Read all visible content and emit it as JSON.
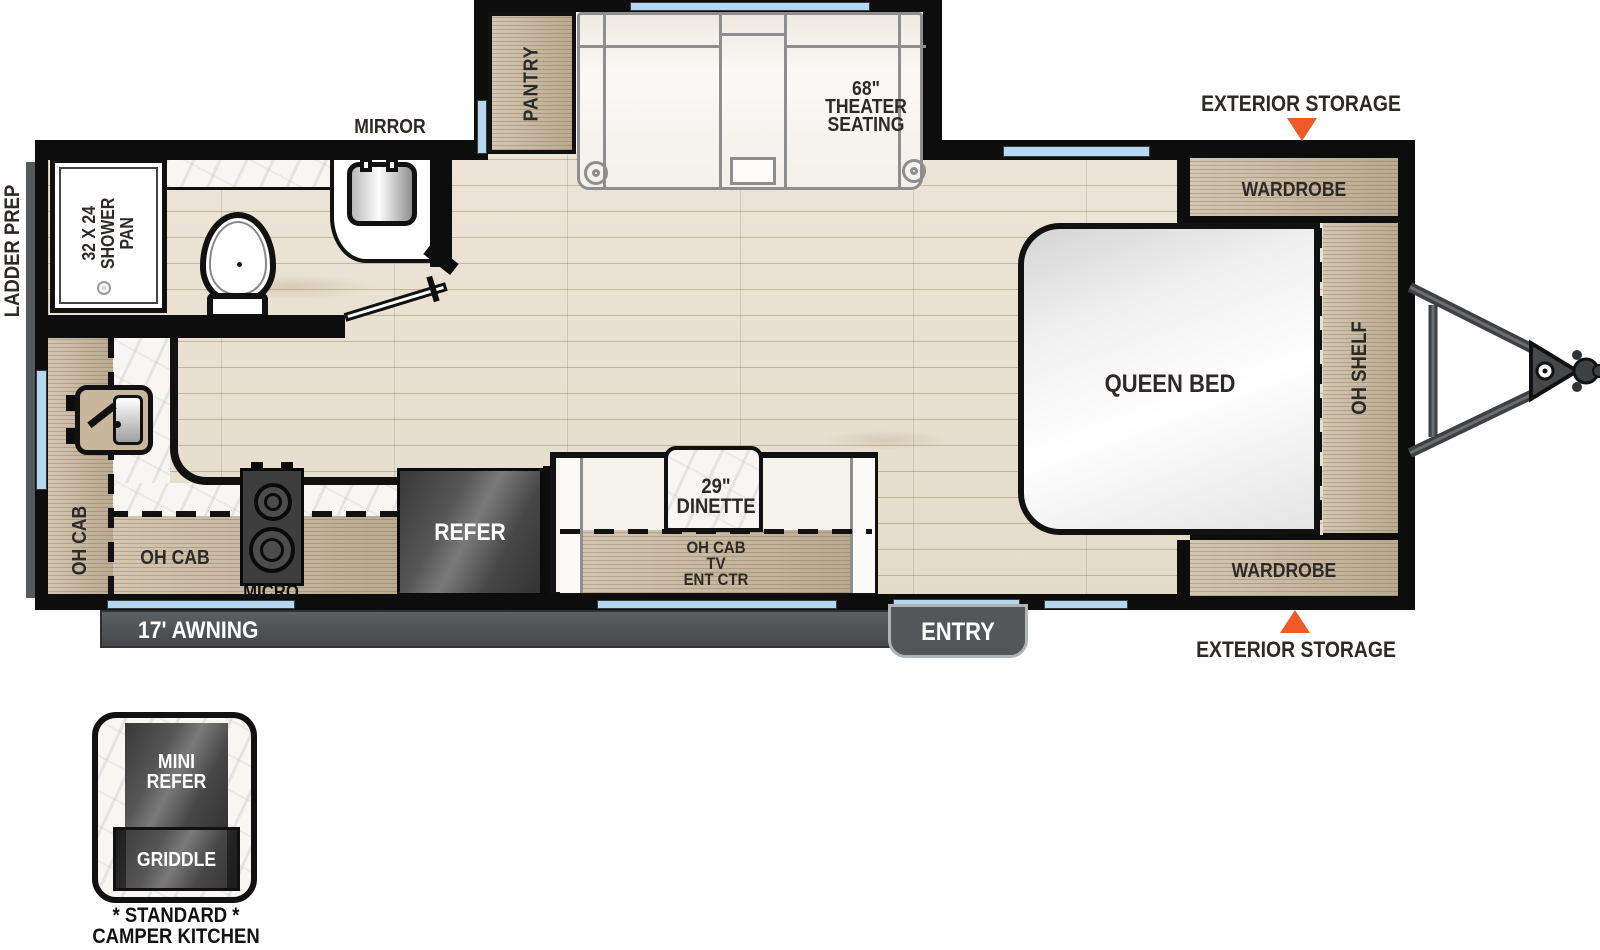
{
  "colors": {
    "accent_orange": "#F05A28",
    "window_blue": "#B4D8F2",
    "cabinet_wood": "#C8B79D",
    "floor_wood": "#E9E2D4",
    "appliance_gray": "#4A4E51",
    "wall_black": "#0D0D0D"
  },
  "exterior": {
    "storage_top": "EXTERIOR STORAGE",
    "storage_bottom": "EXTERIOR STORAGE",
    "ladder_prep": "LADDER PREP",
    "awning": "17' AWNING",
    "entry": "ENTRY"
  },
  "bedroom": {
    "wardrobe_top": "WARDROBE",
    "wardrobe_bottom": "WARDROBE",
    "queen_bed": "QUEEN BED",
    "oh_shelf": "OH SHELF"
  },
  "living": {
    "theater_seating": [
      "68\"",
      "THEATER",
      "SEATING"
    ],
    "pantry": "PANTRY",
    "dinette": [
      "29\"",
      "DINETTE"
    ],
    "dinette_cab": [
      "OH CAB",
      "TV",
      "ENT CTR"
    ]
  },
  "kitchen": {
    "oh_cab_left": "OH CAB",
    "oh_cab_bottom": "OH CAB",
    "micro": "MICRO",
    "refer": "REFER"
  },
  "bathroom": {
    "mirror": "MIRROR",
    "shower": [
      "32 X 24",
      "SHOWER",
      "PAN"
    ]
  },
  "camper_kitchen": {
    "mini_refer": [
      "MINI",
      "REFER"
    ],
    "griddle": "GRIDDLE",
    "caption": [
      "* STANDARD *",
      "CAMPER KITCHEN"
    ]
  }
}
